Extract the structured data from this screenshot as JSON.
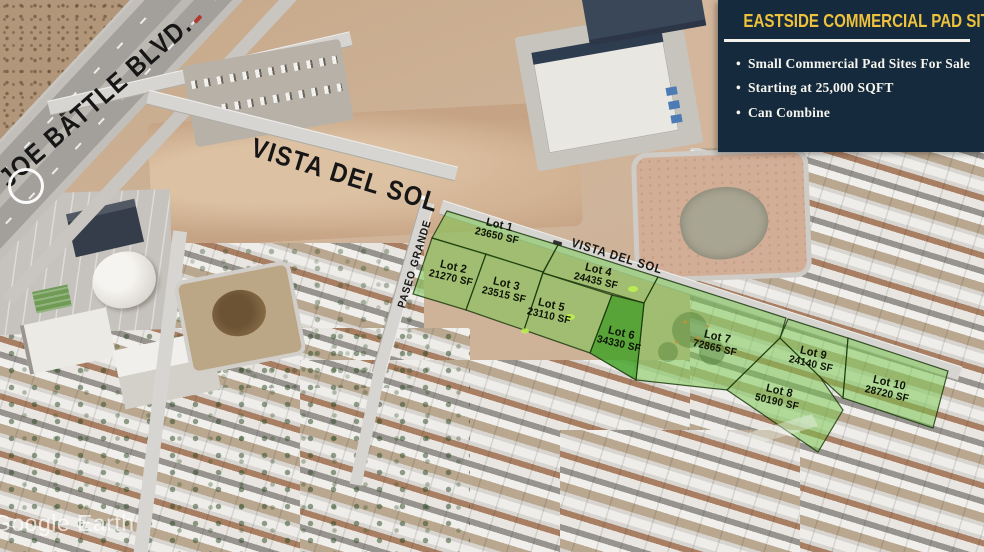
{
  "panel": {
    "title": "EASTSIDE COMMERCIAL PAD SITES",
    "bullet_char": "•",
    "items": [
      "Small Commercial Pad Sites For Sale",
      "Starting at 25,000 SQFT",
      "Can Combine"
    ]
  },
  "map_labels": {
    "joe_battle_blvd": "JOE BATTLE BLVD.",
    "vista_del_sol_upper": "VISTA DEL SOL",
    "vista_del_sol_lower": "VISTA DEL SOL",
    "paseo_grande": "PASEO GRANDE"
  },
  "lots": [
    {
      "name": "Lot 1",
      "size": "23650 SF"
    },
    {
      "name": "Lot 2",
      "size": "21270 SF"
    },
    {
      "name": "Lot 3",
      "size": "23515 SF"
    },
    {
      "name": "Lot 4",
      "size": "24435 SF"
    },
    {
      "name": "Lot 5",
      "size": "23110 SF"
    },
    {
      "name": "Lot 6",
      "size": "34330 SF"
    },
    {
      "name": "Lot 7",
      "size": "72865 SF"
    },
    {
      "name": "Lot 8",
      "size": "50190 SF"
    },
    {
      "name": "Lot 9",
      "size": "24140 SF"
    },
    {
      "name": "Lot 10",
      "size": "28720 SF"
    }
  ],
  "watermark": "Google Earth",
  "colors": {
    "panel_background": "#152a3c",
    "panel_title": "#eec23c",
    "panel_text": "#f6f4ee",
    "lot_fill": "#76c64c",
    "lot6_fill": "#37a01e",
    "lot_border": "#143208",
    "label_text": "#0d1205"
  }
}
